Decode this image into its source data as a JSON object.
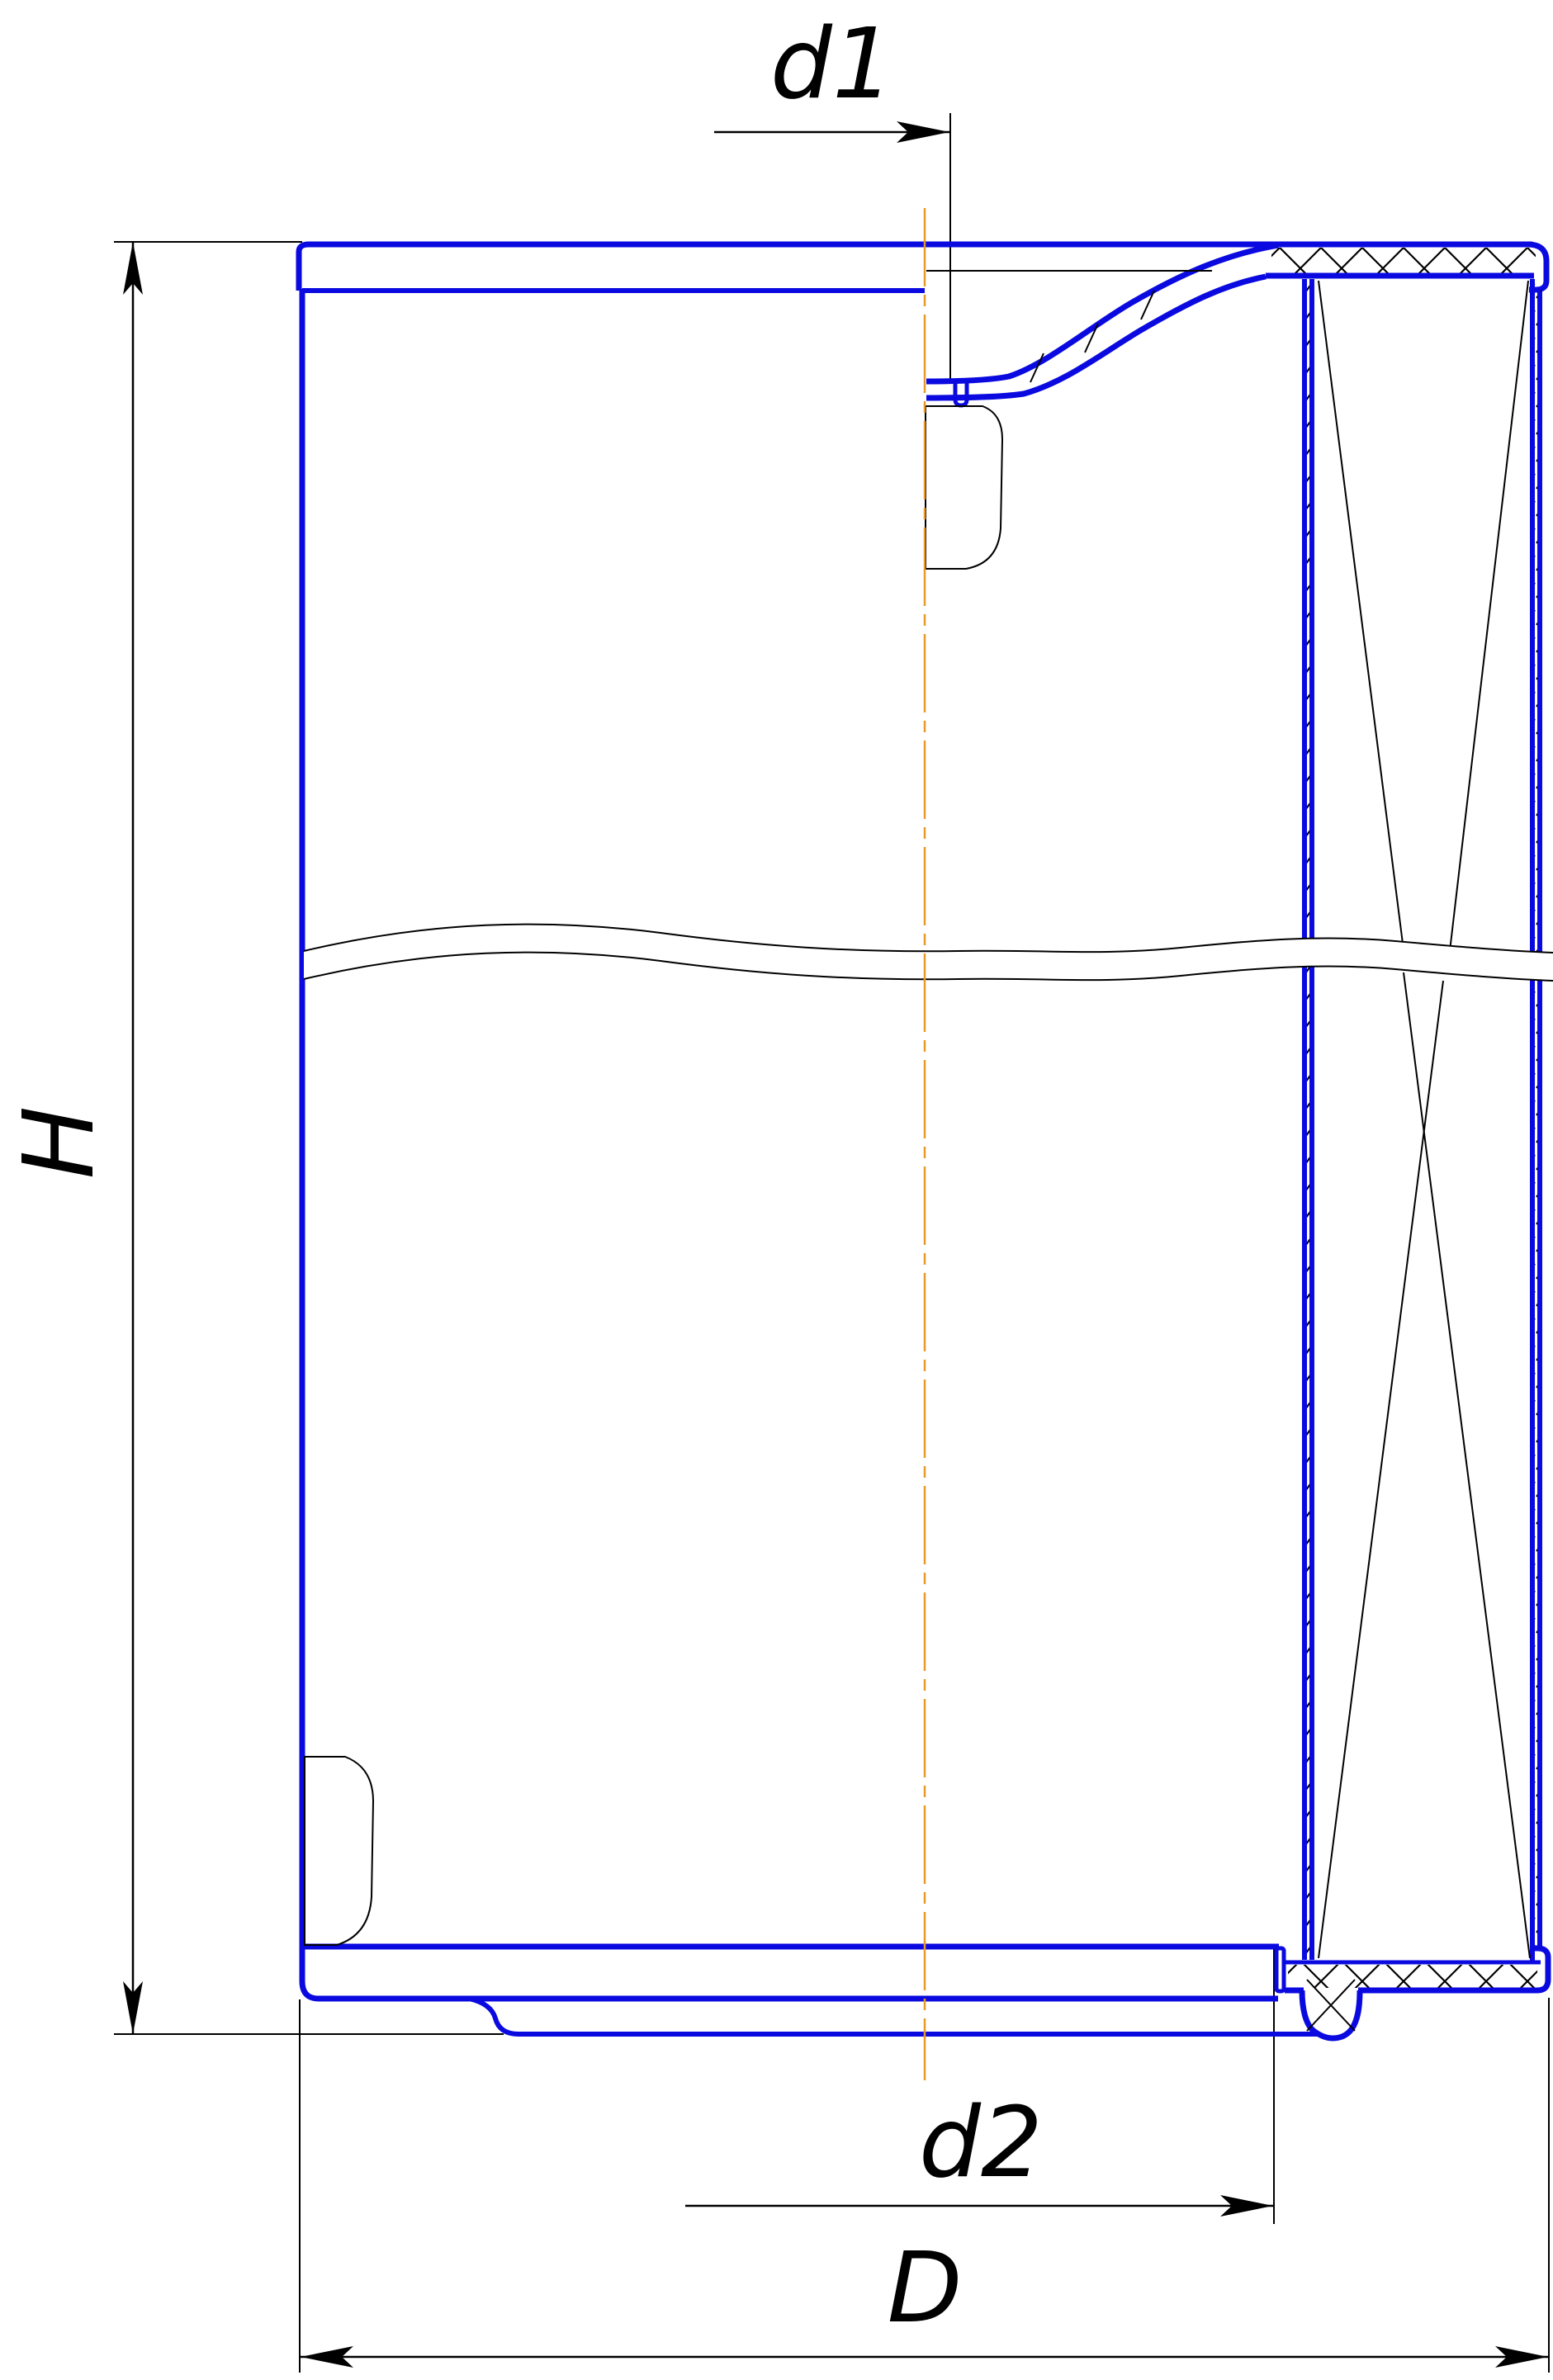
{
  "drawing": {
    "type": "technical-section-drawing",
    "subject": "cylindrical filter element half-section",
    "labels": {
      "height": "H",
      "inner_hole_diameter": "d1",
      "seal_seat_diameter": "d2",
      "outer_diameter": "D"
    },
    "line_roles": {
      "part_outline": "blue solid",
      "center_line": "orange dash-dot",
      "dimension_lines": "black thin with filled arrowheads",
      "section_hatch": "black diagonal cross-hatch",
      "break_line": "double wavy line across body"
    }
  },
  "colors": {
    "part": "#0a0ae0",
    "centerline": "#e8992c",
    "ink": "#000000",
    "bg": "#ffffff"
  }
}
